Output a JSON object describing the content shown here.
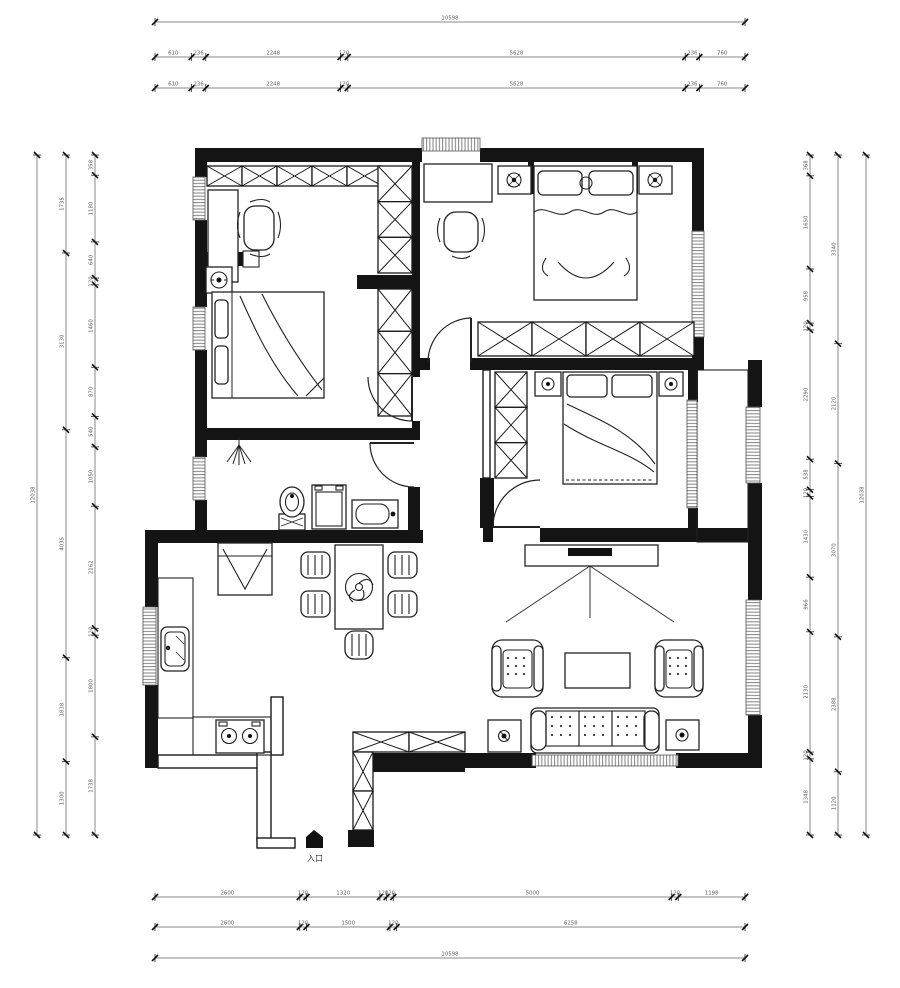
{
  "entry": {
    "label": "入口"
  },
  "colors": {
    "wall": "#141414",
    "line": "#222222",
    "dim_line": "#8a8a8a",
    "dim_text": "#5f5f5f",
    "window_stripe": "#8d8d8d"
  },
  "icons": [
    "wardrobe-x-box",
    "bed",
    "desk",
    "chair",
    "nightstand-lamp",
    "sofa",
    "armchair",
    "coffee-table",
    "tv-stand",
    "dining-table",
    "fan",
    "fridge",
    "stove",
    "sink",
    "toilet",
    "washing-machine",
    "washbasin",
    "shower-head",
    "entry-arrow"
  ],
  "dims": {
    "top": {
      "total": [
        "10598"
      ],
      "row2": [
        "610",
        "236",
        "2248",
        "120",
        "5628",
        "236",
        "760"
      ],
      "row3": [
        "610",
        "236",
        "2248",
        "120",
        "5628",
        "236",
        "760"
      ]
    },
    "bottom": {
      "row1": [
        "2600",
        "120",
        "1320",
        "120",
        "120",
        "5000",
        "120",
        "1198"
      ],
      "row2": [
        "2600",
        "120",
        "1500",
        "120",
        "6258"
      ],
      "total": [
        "10598"
      ]
    },
    "left": {
      "total": [
        "12038"
      ],
      "middle": [
        "1735",
        "3130",
        "4035",
        "1838",
        "1300"
      ],
      "inner": [
        "358",
        "1180",
        "640",
        "120",
        "1460",
        "870",
        "540",
        "1050",
        "2162",
        "120",
        "1800",
        "1738"
      ]
    },
    "right": {
      "inner": [
        "368",
        "1650",
        "958",
        "120",
        "2290",
        "538",
        "120",
        "1430",
        "966",
        "2130",
        "120",
        "1348"
      ],
      "middle": [
        "3340",
        "2120",
        "3070",
        "2388",
        "1120"
      ],
      "total": [
        "12038"
      ]
    }
  }
}
